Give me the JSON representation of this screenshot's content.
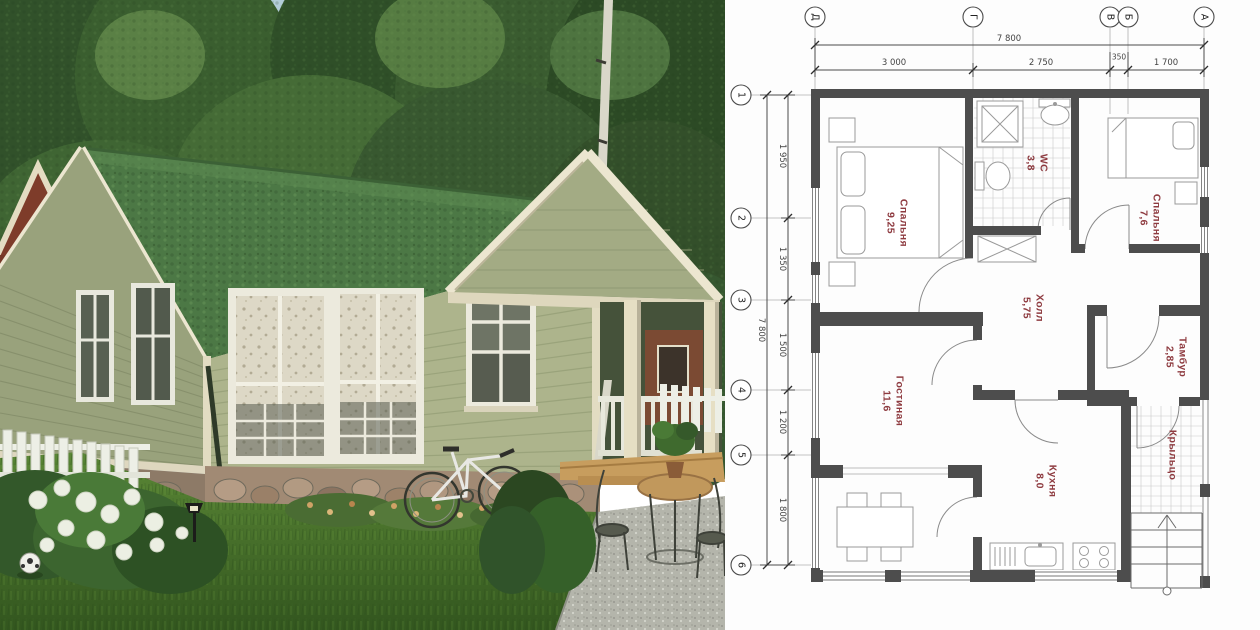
{
  "photo": {
    "colors": {
      "sky": "#b6cdd8",
      "foliage": "#35562b",
      "roof": "#4c7845",
      "siding": "#abb28a",
      "trim": "#ebe5ce",
      "foundation_stone": "#a78e76",
      "lawn": "#49762c",
      "gravel_path": "#b4b5ab",
      "picket_fence": "#edefe6",
      "neighbor_house": "#7c3b28"
    }
  },
  "floor_plan": {
    "axis_columns": [
      "Д",
      "Г",
      "В",
      "Б",
      "А"
    ],
    "axis_rows": [
      "1",
      "2",
      "3",
      "4",
      "5",
      "6"
    ],
    "top_dimensions": {
      "total": "7 800",
      "segments": [
        "3 000",
        "2 750",
        "350",
        "1 700"
      ]
    },
    "left_dimensions": {
      "total": "7 800",
      "segments": [
        "1 950",
        "1 350",
        "1 500",
        "1 200",
        "1 800"
      ]
    },
    "rooms": [
      {
        "name": "Спальня",
        "area": "9,25"
      },
      {
        "name": "WC",
        "area": "3,8"
      },
      {
        "name": "Спальня",
        "area": "7,6"
      },
      {
        "name": "Холл",
        "area": "5,75"
      },
      {
        "name": "Тамбур",
        "area": "2,85"
      },
      {
        "name": "Гостиная",
        "area": "11,6"
      },
      {
        "name": "Кухня",
        "area": "8,0"
      },
      {
        "name": "Крыльцо",
        "area": ""
      }
    ],
    "colors": {
      "wall": "#4d4d4d",
      "room_label": "#8e3b40",
      "dimension_text": "#444444"
    }
  }
}
